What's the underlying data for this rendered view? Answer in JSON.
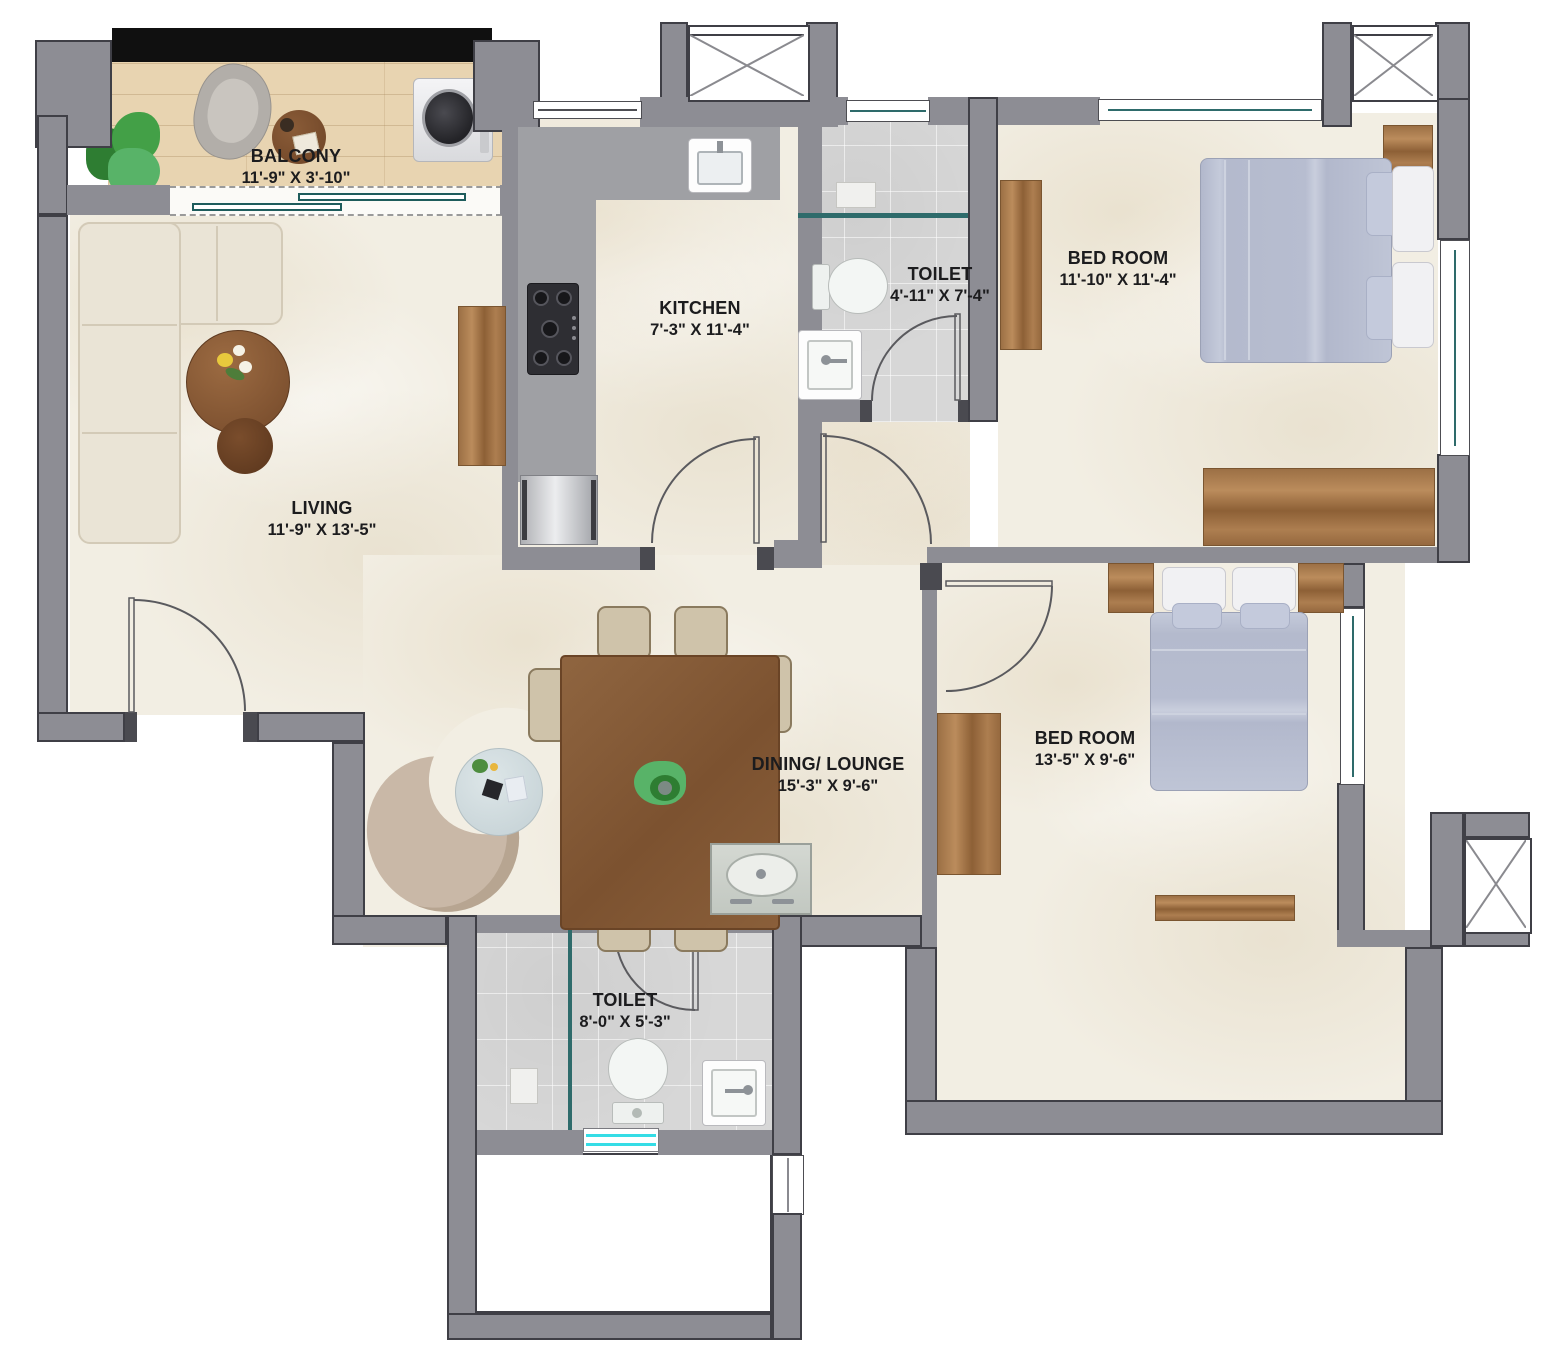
{
  "title": "2 BHK Apartment Floor Plan",
  "rooms": [
    {
      "id": "balcony",
      "name": "BALCONY",
      "dims": "11'-9\" X 3'-10\""
    },
    {
      "id": "living",
      "name": "LIVING",
      "dims": "11'-9\" X 13'-5\""
    },
    {
      "id": "kitchen",
      "name": "KITCHEN",
      "dims": "7'-3\" X 11'-4\""
    },
    {
      "id": "toilet-top",
      "name": "TOILET",
      "dims": "4'-11\" X 7'-4\""
    },
    {
      "id": "bedroom-top",
      "name": "BED ROOM",
      "dims": "11'-10\" X 11'-4\""
    },
    {
      "id": "dining-lounge",
      "name": "DINING/ LOUNGE",
      "dims": "15'-3\" X 9'-6\""
    },
    {
      "id": "bedroom-bottom",
      "name": "BED ROOM",
      "dims": "13'-5\" X 9'-6\""
    },
    {
      "id": "toilet-bottom",
      "name": "TOILET",
      "dims": "8'-0\" X 5'-3\""
    }
  ],
  "colors": {
    "wall": "#8d8d94",
    "wall_outline": "#3f3f46",
    "floor_marble": "#f2eee3",
    "balcony_wood": "#e8d4b1",
    "tile_gray": "#d7d7d7",
    "window_teal": "#2e6b6b",
    "window_cyan": "#35dde6",
    "furniture_wood": "#a5794e",
    "bedding_blue": "#bcc2d5",
    "sofa_cream": "#eae4d6",
    "label_text": "#1c1c1e",
    "balcony_top_strip": "#101010"
  }
}
